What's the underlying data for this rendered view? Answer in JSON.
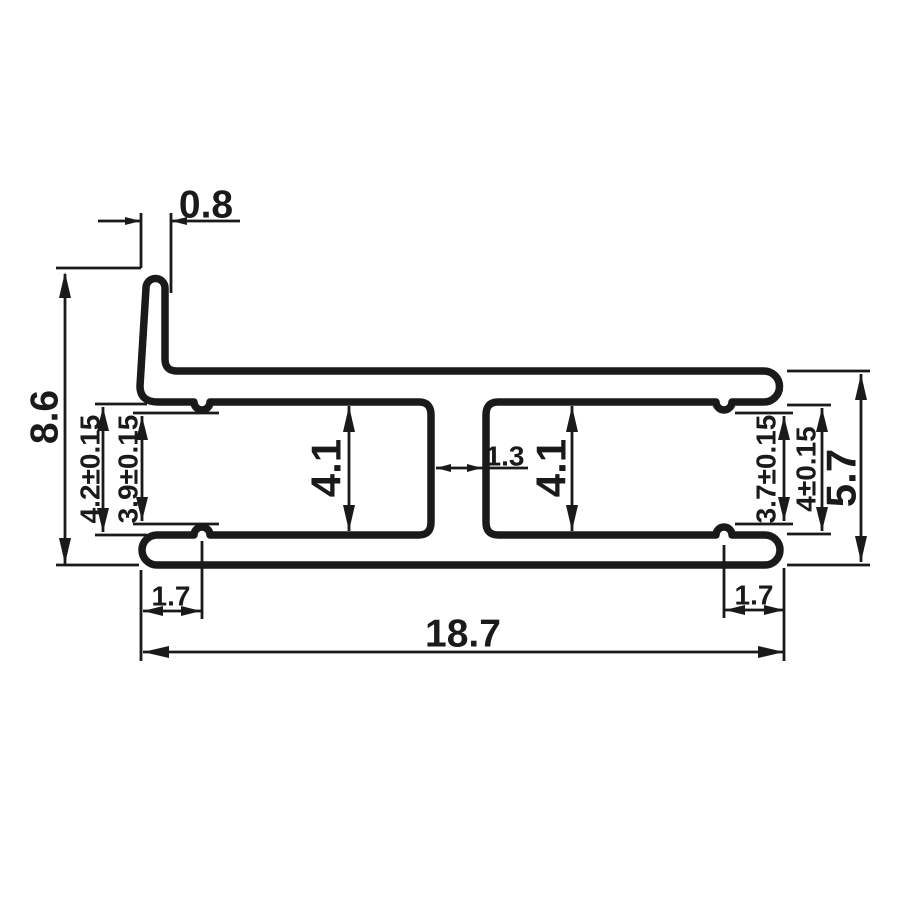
{
  "drawing": {
    "description": "Technical cross-section drawing of an aluminium H-connector profile with one wall flange",
    "colors": {
      "line": "#1a1a1a",
      "background": "#ffffff"
    },
    "dimensions": {
      "flange_thickness": "0.8",
      "overall_height": "8.6",
      "left_opening": "4.2±0.15",
      "left_inner": "3.9±0.15",
      "left_channel": "4.1",
      "web_thickness": "1.3",
      "right_channel": "4.1",
      "right_inner": "3.7±0.15",
      "right_opening": "4±0.15",
      "profile_height": "5.7",
      "left_lip": "1.7",
      "right_lip": "1.7",
      "overall_width": "18.7"
    }
  }
}
